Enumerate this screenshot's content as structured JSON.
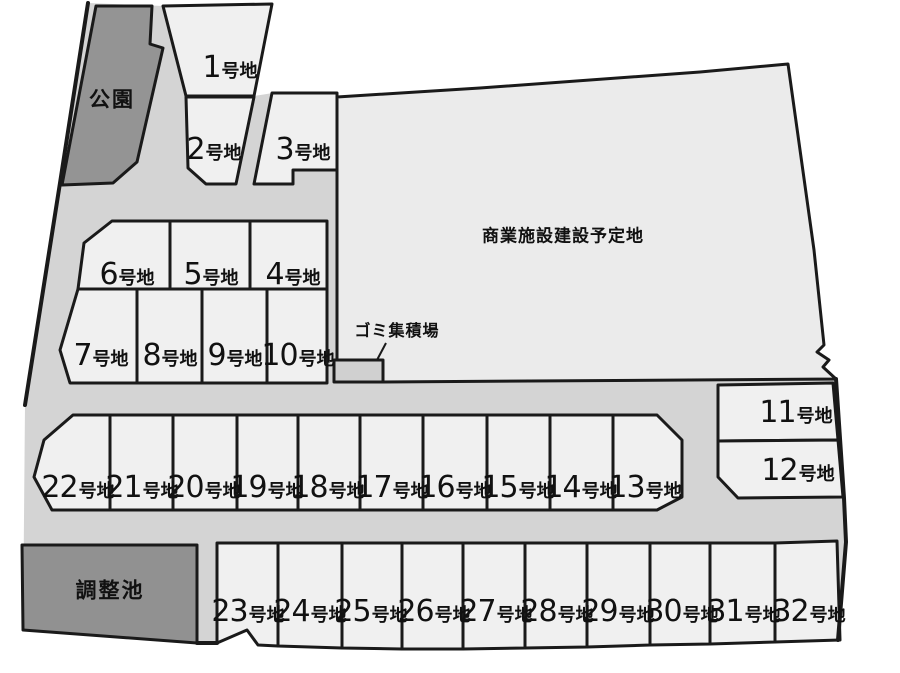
{
  "plan": {
    "park_label": "公園",
    "pond_label": "調整池",
    "commercial_label": "商業施設建設予定地",
    "garbage_label": "ゴミ集積場",
    "lots": [
      {
        "num": "1",
        "suffix": "号地"
      },
      {
        "num": "2",
        "suffix": "号地"
      },
      {
        "num": "3",
        "suffix": "号地"
      },
      {
        "num": "4",
        "suffix": "号地"
      },
      {
        "num": "5",
        "suffix": "号地"
      },
      {
        "num": "6",
        "suffix": "号地"
      },
      {
        "num": "7",
        "suffix": "号地"
      },
      {
        "num": "8",
        "suffix": "号地"
      },
      {
        "num": "9",
        "suffix": "号地"
      },
      {
        "num": "10",
        "suffix": "号地"
      },
      {
        "num": "11",
        "suffix": "号地"
      },
      {
        "num": "12",
        "suffix": "号地"
      },
      {
        "num": "13",
        "suffix": "号地"
      },
      {
        "num": "14",
        "suffix": "号地"
      },
      {
        "num": "15",
        "suffix": "号地"
      },
      {
        "num": "16",
        "suffix": "号地"
      },
      {
        "num": "17",
        "suffix": "号地"
      },
      {
        "num": "18",
        "suffix": "号地"
      },
      {
        "num": "19",
        "suffix": "号地"
      },
      {
        "num": "20",
        "suffix": "号地"
      },
      {
        "num": "21",
        "suffix": "号地"
      },
      {
        "num": "22",
        "suffix": "号地"
      },
      {
        "num": "23",
        "suffix": "号地"
      },
      {
        "num": "24",
        "suffix": "号地"
      },
      {
        "num": "25",
        "suffix": "号地"
      },
      {
        "num": "26",
        "suffix": "号地"
      },
      {
        "num": "27",
        "suffix": "号地"
      },
      {
        "num": "28",
        "suffix": "号地"
      },
      {
        "num": "29",
        "suffix": "号地"
      },
      {
        "num": "30",
        "suffix": "号地"
      },
      {
        "num": "31",
        "suffix": "号地"
      },
      {
        "num": "32",
        "suffix": "号地"
      }
    ]
  },
  "colors": {
    "background": "#ffffff",
    "road_fill": "#d4d4d4",
    "lot_fill": "#f0f0f0",
    "commercial_fill": "#ebebeb",
    "park_fill": "#949494",
    "pond_fill": "#919191",
    "garbage_fill": "#d0d0d0",
    "outline": "#1a1a1a"
  }
}
